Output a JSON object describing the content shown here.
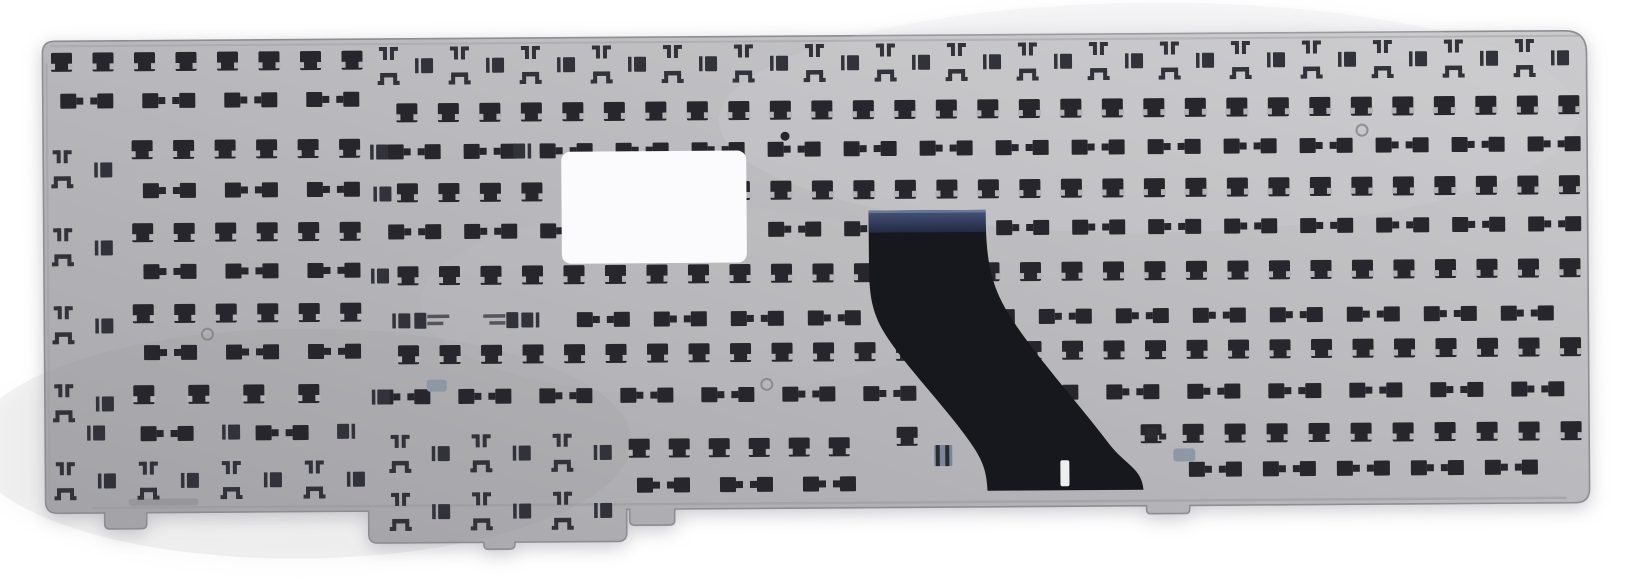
{
  "meta": {
    "subject": "Photograph of the rear metal backplate of a laptop keyboard with stamped clip cutouts, a blank white sticker and a black ribbon cable",
    "background": "#ffffff"
  },
  "plate": {
    "outline_path": "M 56 36 H 1566 Q 1588 36 1588 58 V 494 Q 1588 508 1574 508 H 1188 V 512 Q 1188 516 1184 516 H 1149 Q 1145 516 1145 512 V 508 H 673 V 519 Q 673 524 668 524 H 633 Q 628 524 628 519 V 508 H 625 V 531 Q 625 540 616 540 H 513 V 542 Q 513 547 508 547 H 487 Q 482 547 482 542 V 540 H 376 Q 367 540 367 531 V 508 H 145 V 519 Q 145 524 140 524 H 108 Q 103 524 103 519 V 508 H 56 Q 44 508 44 496 V 48 Q 44 36 56 36 Z",
    "fill_top": "#cbcbcd",
    "fill_mid": "#b8b8bc",
    "fill_bottom": "#a5a5aa",
    "stroke": "#8d8d92",
    "rotation_deg": -0.4,
    "rotation_cx": 816,
    "rotation_cy": 272,
    "shading": [
      {
        "cx": 1150,
        "cy": 120,
        "rx": 430,
        "ry": 115,
        "fill": "#dadadc",
        "opacity": 0.18
      },
      {
        "cx": 300,
        "cy": 440,
        "rx": 330,
        "ry": 115,
        "fill": "#85858b",
        "opacity": 0.1
      },
      {
        "cx": 690,
        "cy": 300,
        "rx": 270,
        "ry": 95,
        "fill": "#cdcdcf",
        "opacity": 0.1
      }
    ],
    "edge_lines": [
      {
        "d": "M 52 41 H 1582",
        "stroke": "#a2a2a6",
        "w": 2,
        "o": 0.55
      },
      {
        "d": "M 90 503 H 1565",
        "stroke": "#96969b",
        "w": 2.4,
        "o": 0.5
      },
      {
        "d": "M 48 58 V 492",
        "stroke": "#9b9b9f",
        "w": 2,
        "o": 0.45
      }
    ]
  },
  "label": {
    "x": 562,
    "y": 150,
    "w": 185,
    "h": 112,
    "rx": 9,
    "fill": "#fbfbfd"
  },
  "cable": {
    "body_path": "M 869 211 L 986 211 C 986 262 990 285 1010 318 C 1035 358 1080 408 1108 446 C 1125 468 1140 470 1142 492 L 986 492 C 985 472 982 462 968 442 C 945 408 900 362 882 330 C 870 308 869 290 869 262 Z",
    "fill": "#17181d",
    "stiffener": {
      "x": 869,
      "y": 211,
      "w": 117,
      "h": 22,
      "fill_top": "#46547a",
      "fill_bottom": "#222b42",
      "highlight": "#6b7c9e"
    },
    "slit": {
      "x": 1059,
      "y": 462,
      "w": 9,
      "h": 26,
      "fill": "#edeef0"
    }
  },
  "cutouts": {
    "color_dark": "#26262c",
    "color_soft": "#32323a",
    "notch": "#b4b4b8",
    "bar": "#55555c",
    "rows": [
      {
        "type": "squares",
        "y": 57,
        "x0": 63,
        "pitch": 41.5,
        "count": 8
      },
      {
        "type": "bowties",
        "y": 96,
        "x0": 88,
        "pitch": 82,
        "count": 4
      },
      {
        "type": "squares",
        "y": 145,
        "x0": 143,
        "pitch": 41.5,
        "count": 6
      },
      {
        "type": "bowties",
        "y": 186,
        "x0": 170,
        "pitch": 82,
        "count": 3
      },
      {
        "type": "squares",
        "y": 228,
        "x0": 143,
        "pitch": 41.5,
        "count": 6
      },
      {
        "type": "bowties",
        "y": 267,
        "x0": 170,
        "pitch": 82,
        "count": 3
      },
      {
        "type": "squares",
        "y": 309,
        "x0": 143,
        "pitch": 41.5,
        "count": 6
      },
      {
        "type": "bowties",
        "y": 348,
        "x0": 170,
        "pitch": 82,
        "count": 3
      },
      {
        "type": "squares",
        "y": 390,
        "x0": 143,
        "pitch": 55,
        "count": 4
      },
      {
        "type": "bowties",
        "y": 429,
        "x0": 166,
        "pitch": 115,
        "count": 2
      },
      {
        "type": "hooks",
        "y": 477,
        "x0": 64,
        "pitch": 83,
        "count": 4
      },
      {
        "type": "hooks",
        "y": 64,
        "x0": 390,
        "pitch": 71,
        "count": 17
      },
      {
        "type": "squares",
        "y": 110,
        "x0": 408,
        "pitch": 41.5,
        "count": 29
      },
      {
        "type": "bowties",
        "y": 149,
        "x0": 415,
        "pitch": 76,
        "count": 16
      },
      {
        "type": "squares",
        "y": 190,
        "x0": 408,
        "pitch": 41.5,
        "count": 29
      },
      {
        "type": "bowties",
        "y": 229,
        "x0": 415,
        "pitch": 76,
        "count": 16
      },
      {
        "type": "squares",
        "y": 273,
        "x0": 408,
        "pitch": 41.5,
        "count": 29
      },
      {
        "type": "bowties",
        "y": 318,
        "x0": 603,
        "pitch": 77,
        "count": 13
      },
      {
        "type": "squares",
        "y": 352,
        "x0": 408,
        "pitch": 41.5,
        "count": 29
      },
      {
        "type": "bowties",
        "y": 394,
        "x0": 403,
        "pitch": 81,
        "count": 15
      },
      {
        "type": "squares",
        "y": 447,
        "x0": 638,
        "pitch": 40,
        "count": 6
      },
      {
        "type": "bowties",
        "y": 484,
        "x0": 662,
        "pitch": 83,
        "count": 3
      },
      {
        "type": "squares",
        "y": 436,
        "x0": 1150,
        "pitch": 42,
        "count": 11
      },
      {
        "type": "bowties",
        "y": 472,
        "x0": 1214,
        "pitch": 74,
        "count": 5
      },
      {
        "type": "hooks",
        "y": 452,
        "x0": 399,
        "pitch": 81,
        "count": 3
      },
      {
        "type": "hooks",
        "y": 510,
        "x0": 399,
        "pitch": 81,
        "count": 3
      }
    ],
    "singles": {
      "hookpairs": [
        [
          63,
          165
        ],
        [
          63,
          243
        ],
        [
          63,
          321
        ],
        [
          63,
          399
        ]
      ],
      "brackets": [
        [
          104,
          165
        ],
        [
          104,
          243
        ],
        [
          104,
          321
        ],
        [
          104,
          399
        ],
        [
          380,
          149
        ],
        [
          383,
          191
        ],
        [
          380,
          273
        ],
        [
          401,
          318
        ],
        [
          380,
          394
        ],
        [
          95,
          428
        ],
        [
          230,
          428
        ]
      ],
      "brackets_r": [
        [
          523,
          149
        ],
        [
          530,
          318
        ],
        [
          345,
          428
        ]
      ],
      "flatbars_l": [
        [
          432,
          318
        ]
      ],
      "flatbars_r": [
        [
          500,
          318
        ]
      ],
      "squares": [
        [
          906,
          437
        ]
      ]
    }
  },
  "marks": {
    "rings": [
      [
        608,
        163
      ],
      [
        1363,
        134
      ],
      [
        207,
        330
      ],
      [
        766,
        384
      ]
    ],
    "dots": [
      [
        786,
        136
      ]
    ],
    "scratch": {
      "x": 127,
      "y": 494,
      "w": 70,
      "h": 7
    },
    "gray_striped": [
      {
        "x": 933,
        "y": 446,
        "w": 18,
        "h": 21
      }
    ],
    "gray_bowls": [
      {
        "x": 1172,
        "y": 451,
        "w": 22,
        "h": 13
      },
      {
        "x": 426,
        "y": 377,
        "w": 20,
        "h": 12
      }
    ],
    "dark_bits": [
      [
        1144,
        430,
        12,
        10
      ],
      [
        1158,
        436,
        7,
        6
      ]
    ]
  }
}
